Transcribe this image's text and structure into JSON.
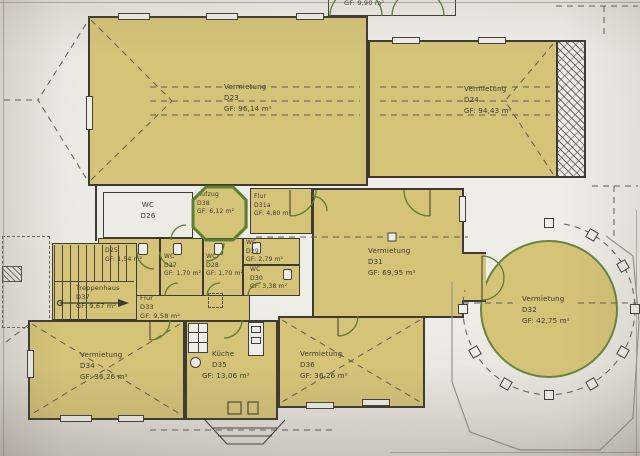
{
  "drawing": {
    "rooms": {
      "d22": {
        "number": "D22",
        "area": "GF: 9,90 m²"
      },
      "d23": {
        "name": "Vermietung",
        "number": "D23",
        "area": "GF: 96,14 m²"
      },
      "d24": {
        "name": "Vermietung",
        "number": "D24",
        "area": "GF: 94,43 m²"
      },
      "d25": {
        "number": "D25",
        "area": "GF: 1,54 m²"
      },
      "d26": {
        "name": "WC",
        "number": "D26"
      },
      "d27": {
        "name": "WC",
        "number": "D27",
        "area": "GF: 1,70 m²"
      },
      "d28": {
        "name": "WC",
        "number": "D28",
        "area": "GF: 1,70 m²"
      },
      "d29": {
        "name": "WC",
        "number": "D29",
        "area": "GF: 2,79 m²"
      },
      "d30": {
        "name": "WC",
        "number": "D30",
        "area": "GF: 3,38 m²"
      },
      "d31": {
        "name": "Vermietung",
        "number": "D31",
        "area": "GF: 69,95 m²"
      },
      "d31a": {
        "name": "Flur",
        "number": "D31a",
        "area": "GF: 4,80 m²"
      },
      "d32": {
        "name": "Vermietung",
        "number": "D32",
        "area": "GF: 42,75 m²"
      },
      "d33": {
        "name": "Flur",
        "number": "D33",
        "area": "GF: 9,58 m²"
      },
      "d34": {
        "name": "Vermietung",
        "number": "D34",
        "area": "GF: 36,26 m²"
      },
      "d35": {
        "name": "Küche",
        "number": "D35",
        "area": "GF: 13,06 m²"
      },
      "d36": {
        "name": "Vermietung",
        "number": "D36",
        "area": "GF: 36,26 m²"
      },
      "d37": {
        "name": "Treppenhaus",
        "number": "D37",
        "area": "GF: 9,67 m²"
      },
      "d38": {
        "name": "Aufzug",
        "number": "D38",
        "area": "GF: 6,12 m²"
      }
    },
    "colors": {
      "room_fill": "#d5c378",
      "accent_green": "#5c8033",
      "paper": "#e9e6e0",
      "line": "#3f3b34"
    }
  }
}
